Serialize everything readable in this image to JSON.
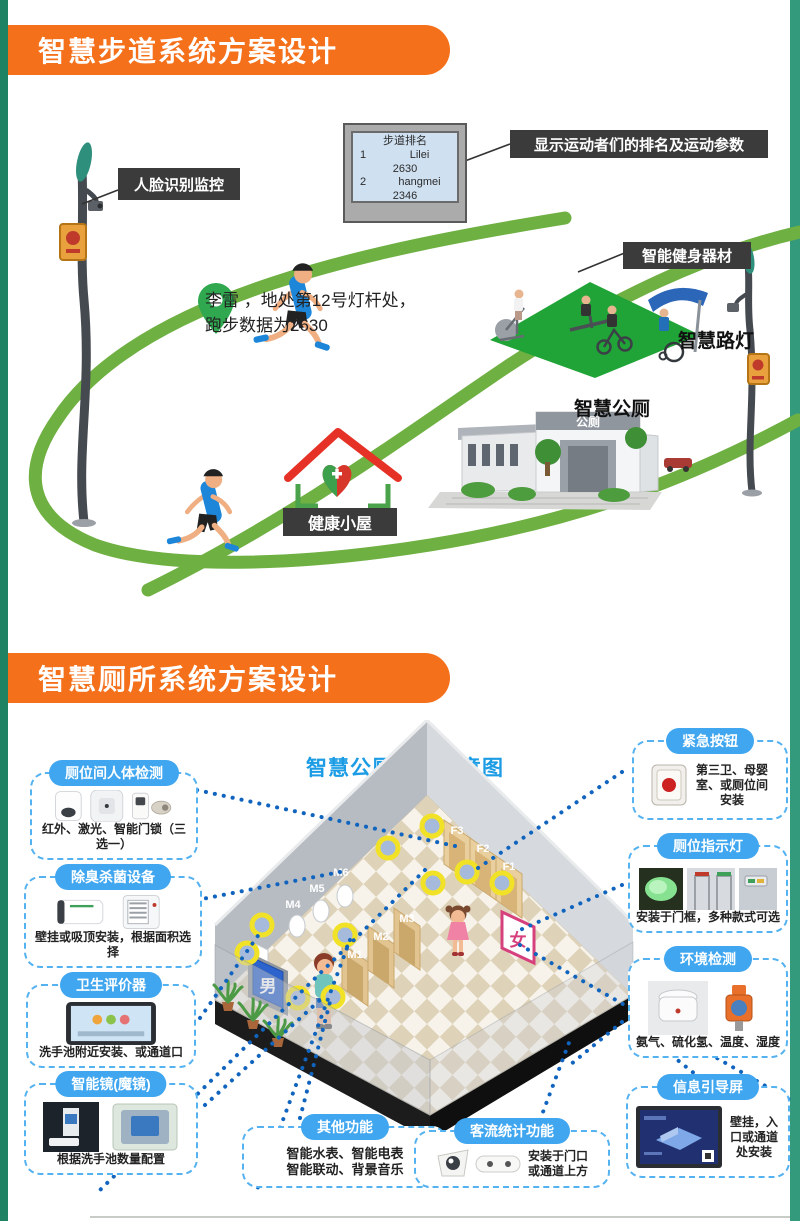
{
  "page": {
    "bg": "#2E9374",
    "accent_orange": "#F5701B",
    "label_dark": "#3B3B3B",
    "path_green": "#6FB042",
    "pill_blue": "#3FA6EF",
    "dotted_blue": "#1064BE",
    "title_blue": "#1B9CE4",
    "marker_yellow": "#F2E227"
  },
  "s1": {
    "banner": "智慧步道系统方案设计",
    "board": {
      "title": "步道排名",
      "rows": [
        {
          "rank": "1",
          "name": "Lilei",
          "value": "2630"
        },
        {
          "rank": "2",
          "name": "hangmei",
          "value": "2346"
        }
      ]
    },
    "board_note": "显示运动者们的排名及运动参数",
    "face_label": "人脸识别监控",
    "runner_line1": "李雷 ，地处第12号灯杆处，",
    "runner_line2": "跑步数据为2630",
    "fitness_label": "智能健身器材",
    "lamp_label": "智慧路灯",
    "toilet_label": "智慧公厕",
    "toilet_sign": "公厕",
    "hut_label": "健康小屋"
  },
  "s2": {
    "banner": "智慧厕所系统方案设计",
    "diagram": {
      "title": "智慧公厕功能示意图",
      "male": "男",
      "female": "女",
      "stalls_m": [
        "M1",
        "M2",
        "M3",
        "M4",
        "M5",
        "M6"
      ],
      "stalls_f": [
        "F3",
        "F2",
        "F1"
      ]
    },
    "left_boxes": [
      {
        "title": "厕位间人体检测",
        "caption": "红外、激光、智能门锁（三选一）"
      },
      {
        "title": "除臭杀菌设备",
        "caption": "壁挂或吸顶安装，根据面积选择"
      },
      {
        "title": "卫生评价器",
        "caption": "洗手池附近安装、或通道口"
      },
      {
        "title": "智能镜(魔镜)",
        "caption": "根据洗手池数量配置"
      }
    ],
    "right_boxes": [
      {
        "title": "紧急按钮",
        "caption": "第三卫、母婴室、或厕位间安装"
      },
      {
        "title": "厕位指示灯",
        "caption": "安装于门框，多种款式可选"
      },
      {
        "title": "环境检测",
        "caption": "氨气、硫化氢、温度、湿度"
      },
      {
        "title": "信息引导屏",
        "caption": "壁挂，入口或通道处安装"
      }
    ],
    "bottom_boxes": [
      {
        "title": "其他功能",
        "line1": "智能水表、智能电表",
        "line2": "智能联动、背景音乐"
      },
      {
        "title": "客流统计功能",
        "line1": "安装于门口",
        "line2": "或通道上方"
      }
    ]
  }
}
